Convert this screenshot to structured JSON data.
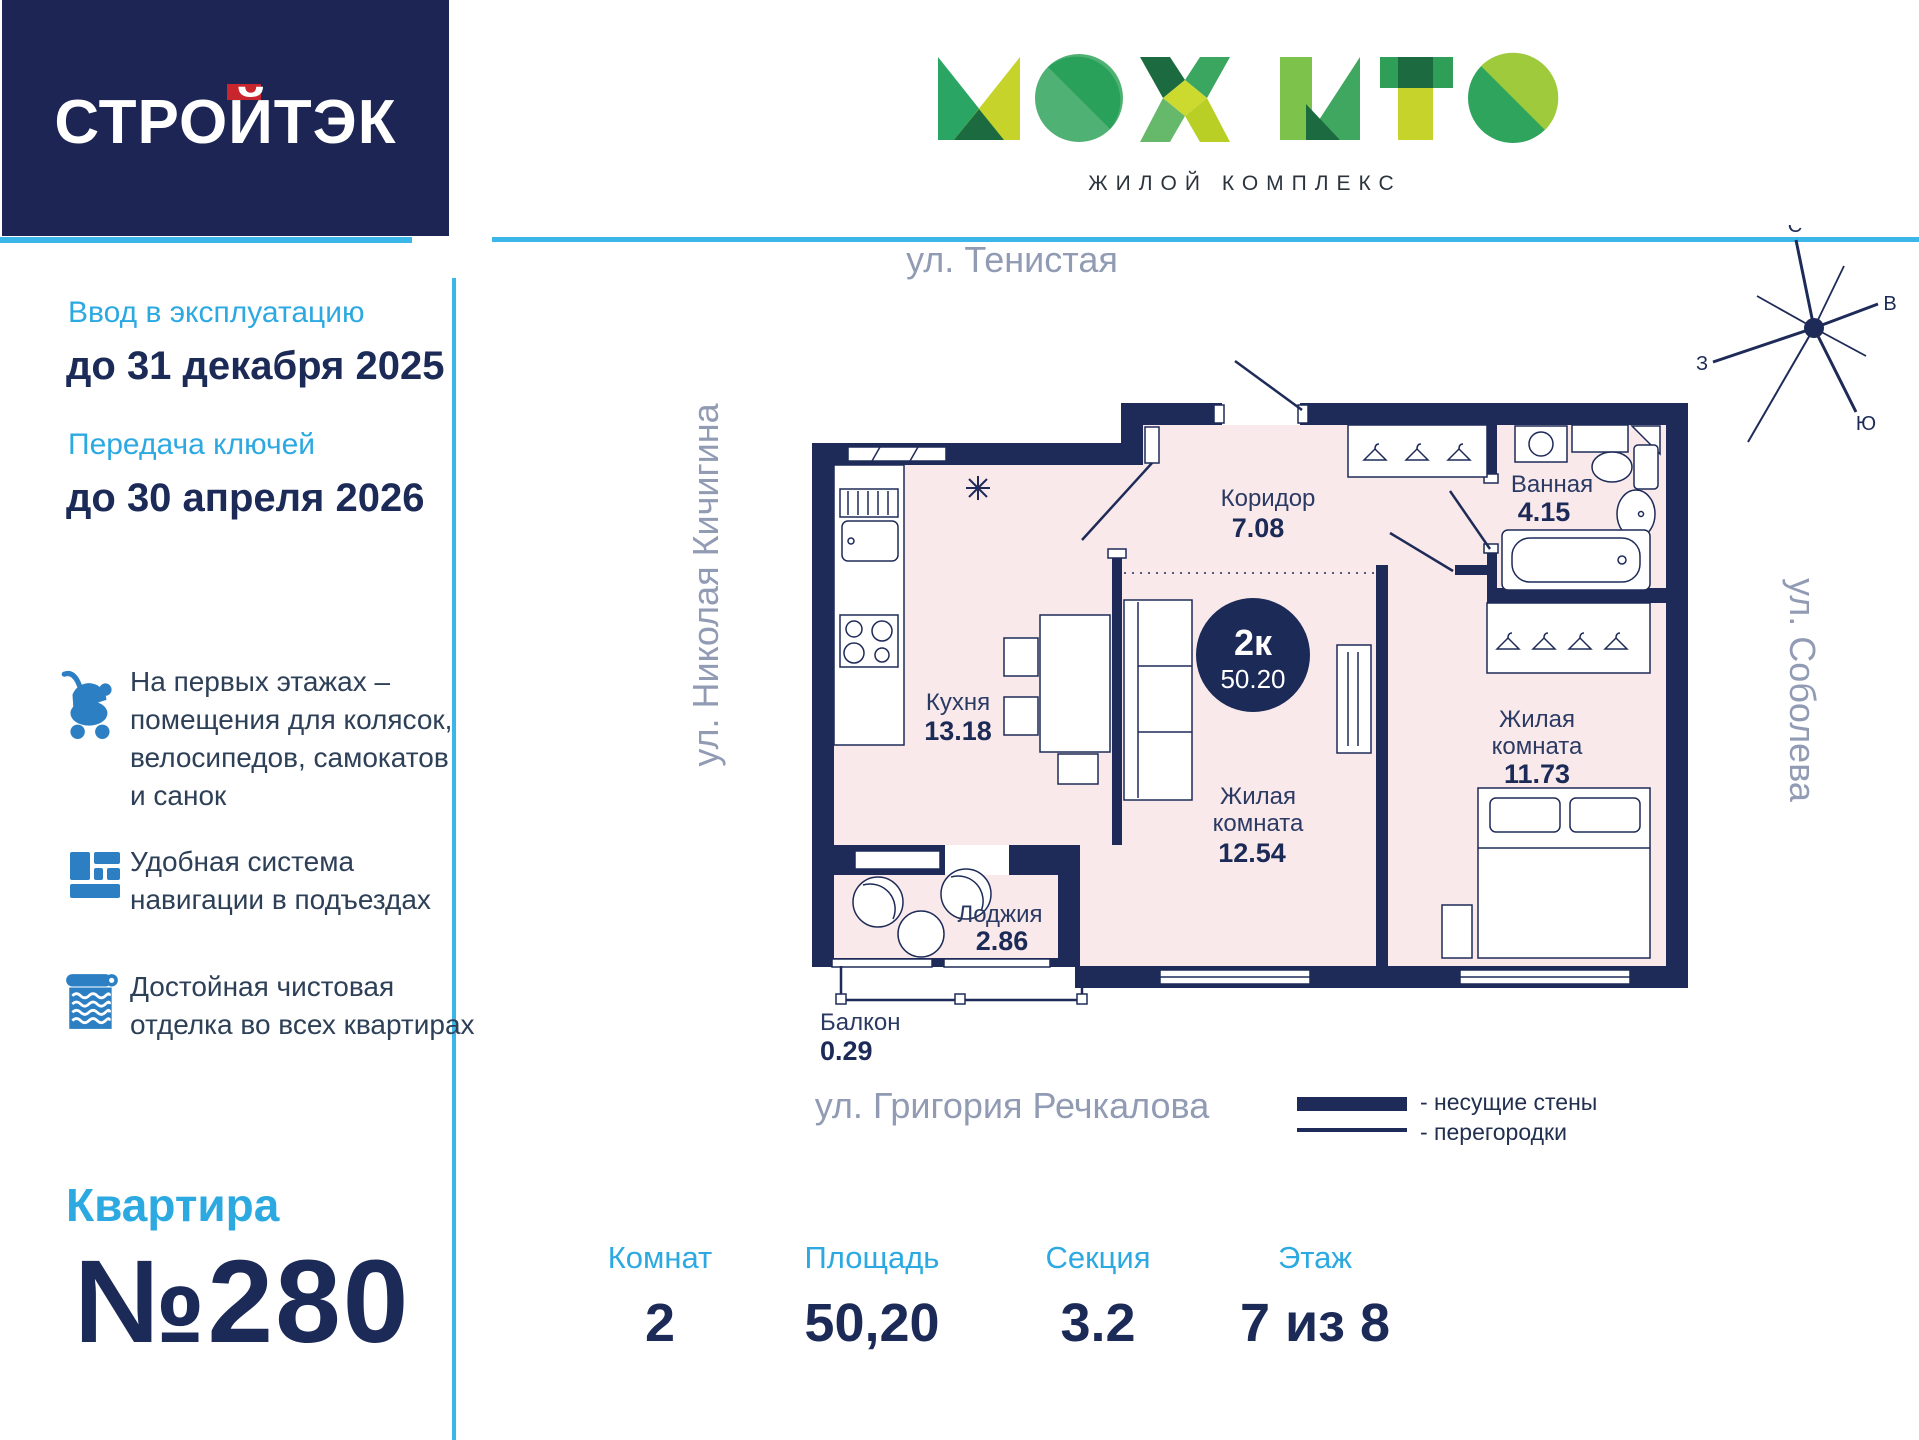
{
  "brand": {
    "developer": "СТРОЙТЭК",
    "complex_name": "МОХИТО",
    "complex_subtitle": "ЖИЛОЙ КОМПЛЕКС"
  },
  "sidebar": {
    "commissioning_label": "Ввод в эксплуатацию",
    "commissioning_date": "до 31 декабря 2025",
    "keys_label": "Передача ключей",
    "keys_date": "до 30 апреля 2026",
    "features": [
      {
        "icon": "stroller-icon",
        "text": "На первых этажах –\nпомещения для колясок,\nвелосипедов, самокатов\nи санок"
      },
      {
        "icon": "navigation-tiles-icon",
        "text": "Удобная система\nнавигации в подъездах"
      },
      {
        "icon": "wallpaper-roll-icon",
        "text": "Достойная чистовая\nотделка во всех квартирах"
      }
    ],
    "apartment_label": "Квартира",
    "apartment_number": "№280"
  },
  "plan": {
    "streets": {
      "top": "ул. Тенистая",
      "left": "ул. Николая Кичигина",
      "right": "ул. Соболева",
      "bottom": "ул. Григория Речкалова"
    },
    "badge": {
      "rooms": "2к",
      "area": "50.20"
    },
    "rooms": {
      "corridor": {
        "name": "Коридор",
        "area": "7.08"
      },
      "bathroom": {
        "name": "Ванная",
        "area": "4.15"
      },
      "kitchen": {
        "name": "Кухня",
        "area": "13.18"
      },
      "living1": {
        "name_line1": "Жилая",
        "name_line2": "комната",
        "area": "12.54"
      },
      "living2": {
        "name_line1": "Жилая",
        "name_line2": "комната",
        "area": "11.73"
      },
      "loggia": {
        "name": "Лоджия",
        "area": "2.86"
      },
      "balcony": {
        "name": "Балкон",
        "area": "0.29"
      }
    },
    "compass": {
      "n": "С",
      "e": "В",
      "w": "З",
      "s": "Ю"
    },
    "legend": {
      "bearing": "- несущие стены",
      "partition": "- перегородки"
    }
  },
  "stats": [
    {
      "label": "Комнат",
      "value": "2"
    },
    {
      "label": "Площадь",
      "value": "50,20"
    },
    {
      "label": "Секция",
      "value": "3.2"
    },
    {
      "label": "Этаж",
      "value": "7 из 8"
    }
  ],
  "colors": {
    "navy": "#1b2a56",
    "cyan_accent": "#2ca9e1",
    "cyan_line": "#3ab6e8",
    "red_accent": "#c9252d",
    "room_fill": "#f9e9eb",
    "street_gray": "#929bb4",
    "icon_blue": "#2d7fc3",
    "logo_teal": "#2aa563",
    "logo_lime": "#c5d32b",
    "logo_dark_green": "#1c6b40"
  }
}
